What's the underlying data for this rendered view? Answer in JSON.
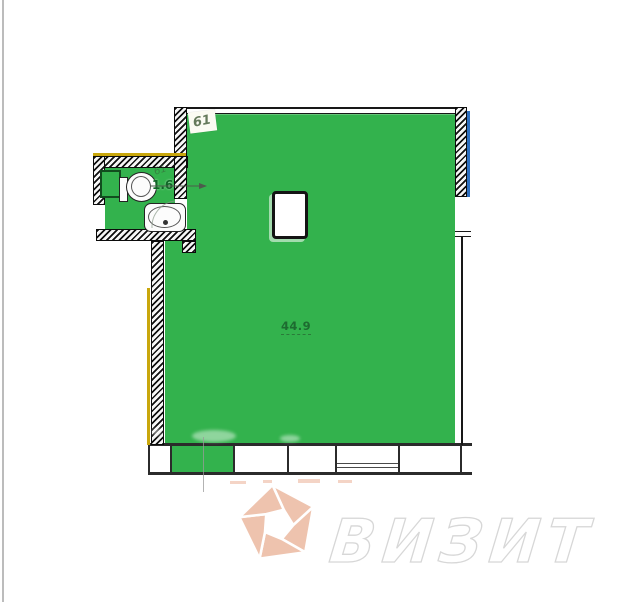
{
  "page": {
    "background": "#ffffff",
    "edge_line_color": "#bcbcbc"
  },
  "floorplan": {
    "unit_number": "61",
    "rooms": {
      "main": {
        "area": "44.9"
      },
      "bathroom": {
        "area": "1.6",
        "handwritten_note": "61"
      }
    },
    "fixtures": [
      "toilet",
      "sink"
    ],
    "colors": {
      "room_fill": "#33b24d",
      "area_label_text": "#1d6b30",
      "wall_line": "#111111",
      "insulation_yellow": "#c9a70c",
      "exterior_blue": "#2e6fbe"
    }
  },
  "watermark": {
    "brand": "ВИЗИТ",
    "logo": "pentagon-shutter",
    "logo_color": "#eec3ae",
    "text_color": "#ffffff",
    "text_outline_color": "#d7d7d7"
  }
}
